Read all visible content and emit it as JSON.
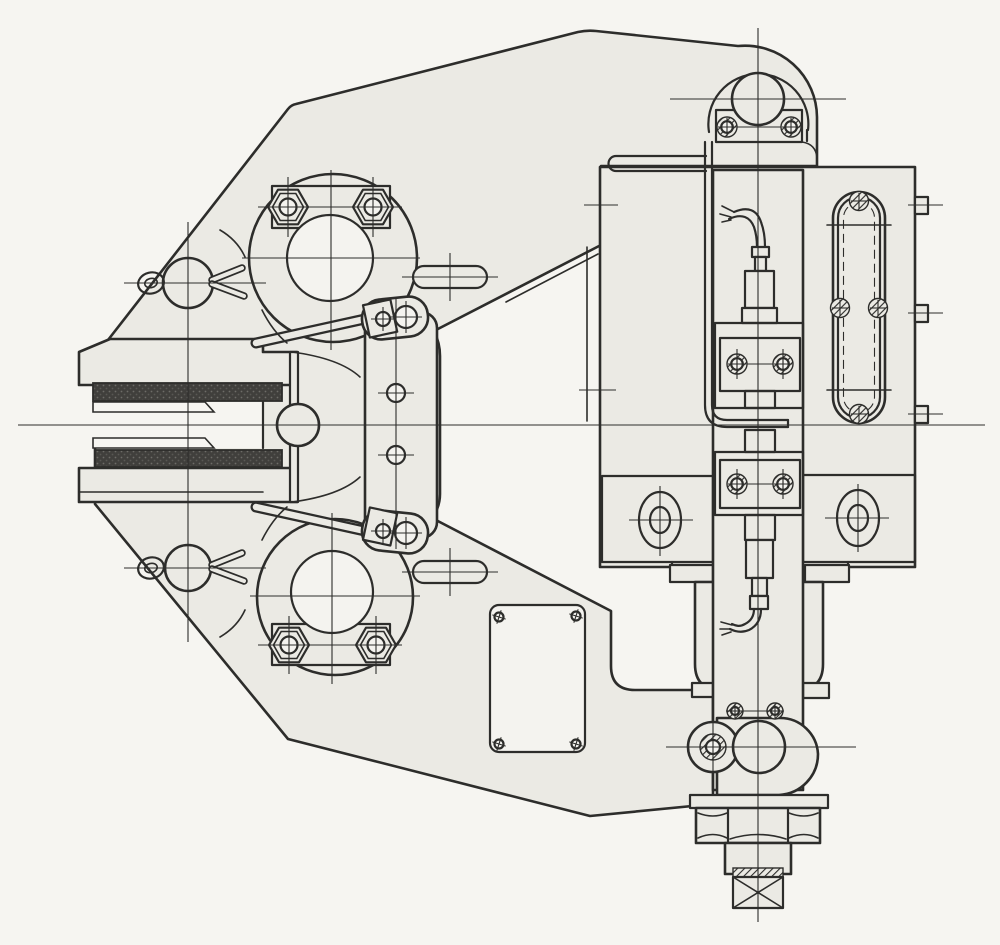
{
  "canvas": {
    "width": 1000,
    "height": 945
  },
  "colors": {
    "paper": "#f6f5f1",
    "metal": "#ebeae4",
    "line": "#2d2d2b",
    "pad_dark": "#403f3c",
    "hole": "#f4f3ef"
  },
  "strokes": {
    "outline": 2.6,
    "medium": 2.2,
    "thin": 1.6,
    "centerline": 1.1
  },
  "drawing": {
    "kind": "mechanical-assembly-side-elevation",
    "text_labels": [],
    "parts": [
      "caliper-body",
      "upper-pad-holder",
      "lower-pad-holder",
      "upper-friction-pad",
      "lower-friction-pad",
      "pusher-piston",
      "upper-pull-rod",
      "lower-pull-rod",
      "center-lever-link",
      "upper-pivot-boss",
      "lower-pivot-boss",
      "upper-hex-nuts",
      "lower-hex-nuts",
      "upper-retainer-pin",
      "lower-retainer-pin",
      "upper-cotter-pin",
      "lower-cotter-pin",
      "actuator-housing",
      "slotted-window",
      "roller-hook-bracket",
      "guide-roller",
      "roller-clamp-bracket",
      "cable-conduit",
      "upper-load-cell",
      "lower-load-cell",
      "sensor-carrier-bar",
      "mounting-boot",
      "pivot-lobe-bracket",
      "anchor-hex-nut",
      "threaded-shank",
      "end-cross-block",
      "cover-plate",
      "side-tabs",
      "inspection-holes"
    ]
  }
}
